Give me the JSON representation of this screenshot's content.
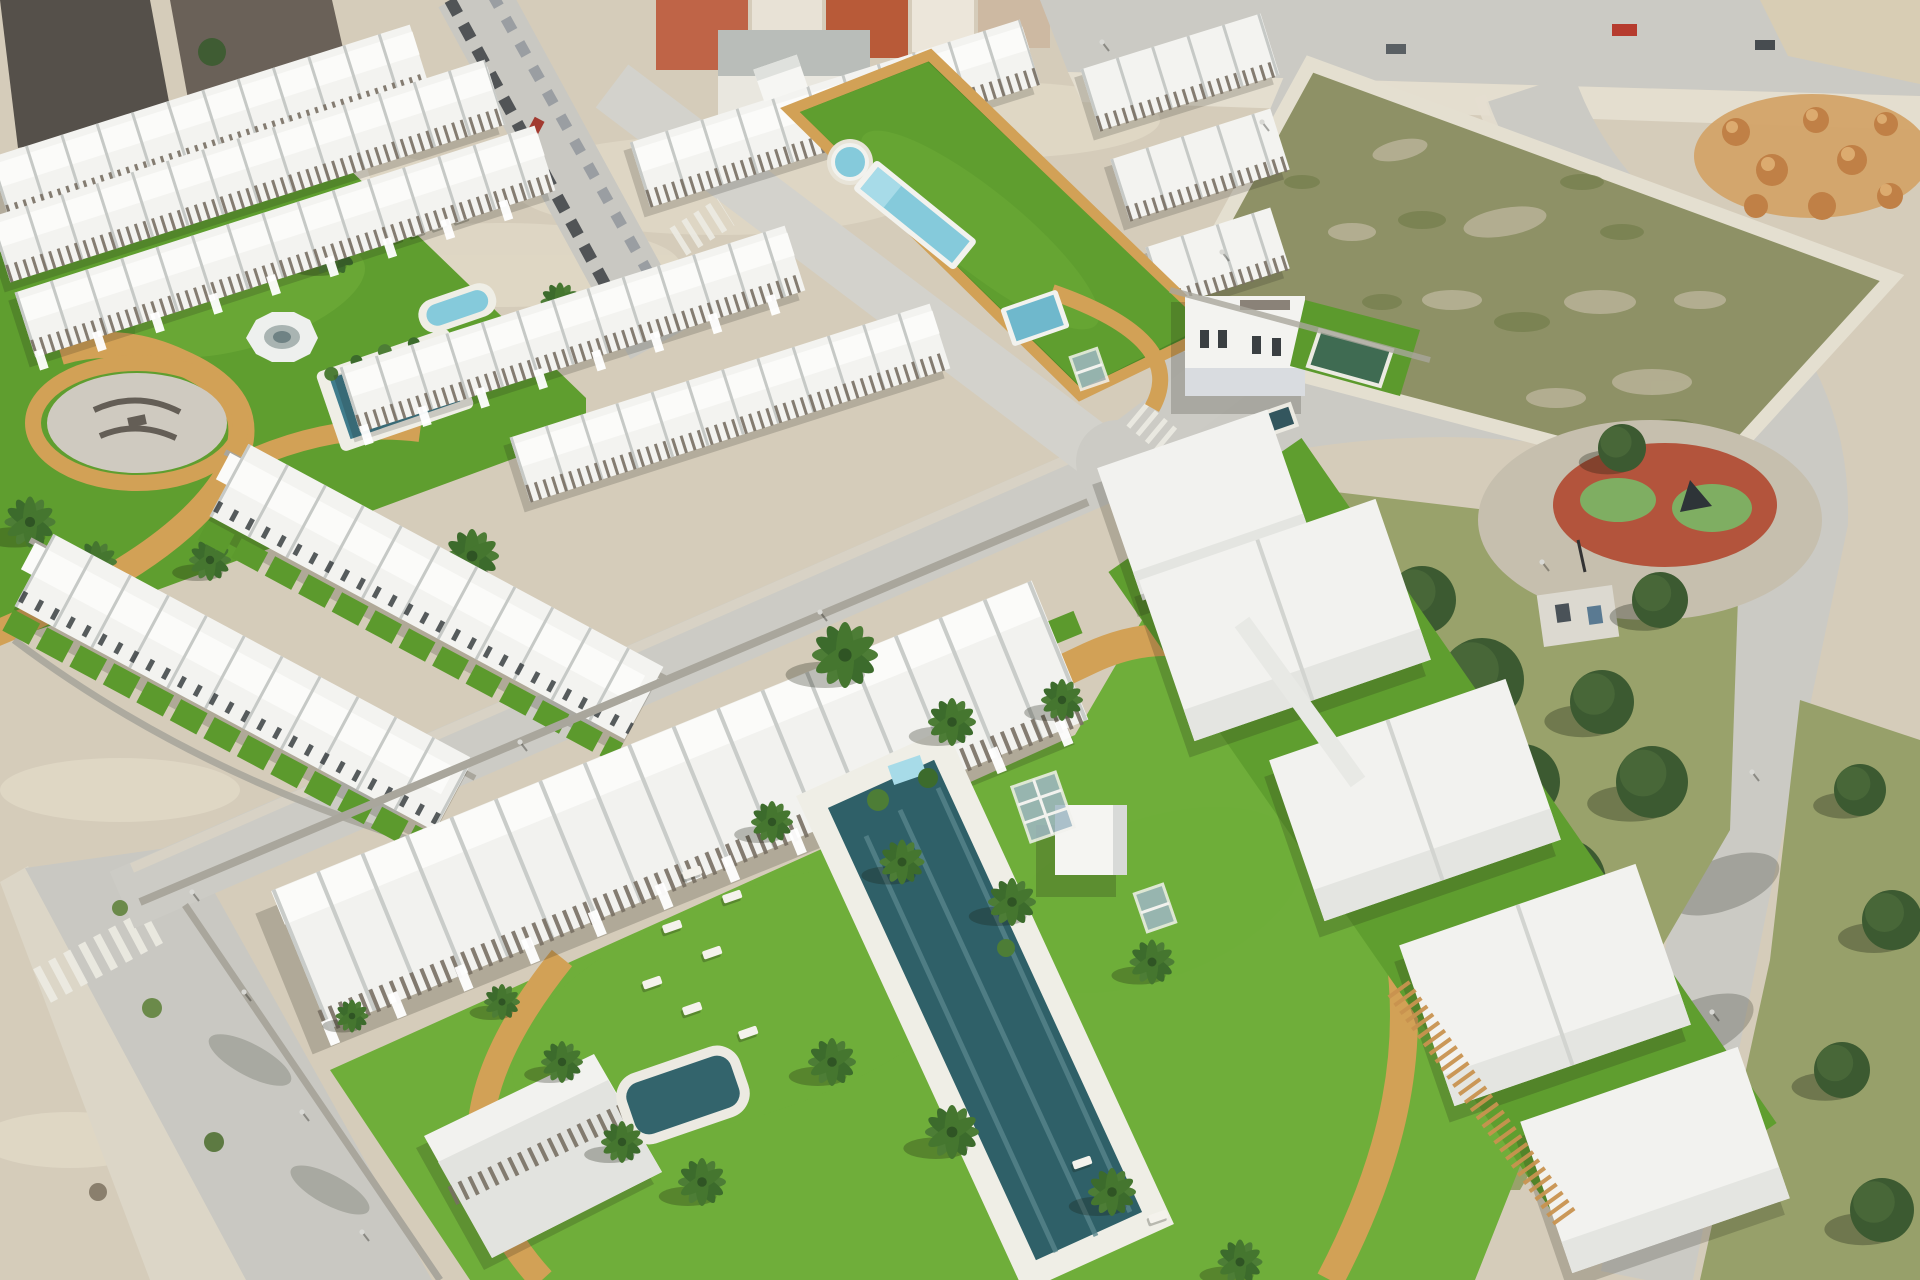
{
  "scene": {
    "description": "Aerial 3D rendering of a new-build Mediterranean residential development: rows of white townhouses around a communal lap-pool garden, a circular plaza garden with palm trees, a large apartment complex with a big dark-teal pool, sun loungers and tan walking paths, bordered by roads with zebra crossings, an old town block, a vacant scrub plot, orange dirt mounds and a public park with a round red playground.",
    "areas": [
      {
        "id": "old-town",
        "name": "old town block"
      },
      {
        "id": "townhouse-rows",
        "name": "white townhouse rows"
      },
      {
        "id": "lap-pool-garden",
        "name": "lap pool garden strip"
      },
      {
        "id": "plaza-garden",
        "name": "circular plaza garden"
      },
      {
        "id": "vacant-plot",
        "name": "vacant scrub plot"
      },
      {
        "id": "dirt-mounds",
        "name": "dirt mounds"
      },
      {
        "id": "public-park",
        "name": "public park"
      },
      {
        "id": "playground",
        "name": "round playground"
      },
      {
        "id": "apartment-complex",
        "name": "lower apartment complex"
      },
      {
        "id": "main-pool",
        "name": "main swimming pool"
      },
      {
        "id": "kids-pool",
        "name": "small pool"
      },
      {
        "id": "roads",
        "name": "perimeter roads"
      }
    ]
  },
  "palette": {
    "base": "#d5ccba",
    "sandLight": "#e2dbc9",
    "road": "#cbcac4",
    "roadLight": "#d8d7d1",
    "sidewalk": "#e4decf",
    "grass": "#5f9e2f",
    "grassLight": "#6fae3a",
    "grassDark": "#4e8a28",
    "parkGrass": "#99a26b",
    "scrub": "#8e9166",
    "scrubDark": "#77804f",
    "pine": "#3c5a31",
    "pineDark": "#2c4525",
    "palmLeaf": "#4d7d36",
    "palmLeafDark": "#3c6b2c",
    "building": "#f3f3f0",
    "roofHighlight": "#fbfbf9",
    "facadeShade": "#d9dce0",
    "pergolaWood": "#786f63",
    "stoneWall": "#a9a69c",
    "townRoof": "#55504a",
    "townRoofDark": "#46413b",
    "townWall": "#e7e1d4",
    "terracotta": "#bf6447",
    "poolAqua": "#85cadb",
    "poolTeal": "#2f6068",
    "poolTealLight": "#57858c",
    "poolGreen": "#3f6b52",
    "pathTan": "#d2a156",
    "pergolaTan": "#c8924f",
    "deck": "#efeee6",
    "playRed": "#b3543c",
    "playGreen": "#7fae62",
    "playPave": "#c6bfae",
    "dirt": "#d3a368",
    "dirtDark": "#c08046",
    "carRed": "#b63b2e",
    "carDark": "#3c4043",
    "crosswalk": "#eceae2",
    "glass": "#9fb7c4"
  }
}
